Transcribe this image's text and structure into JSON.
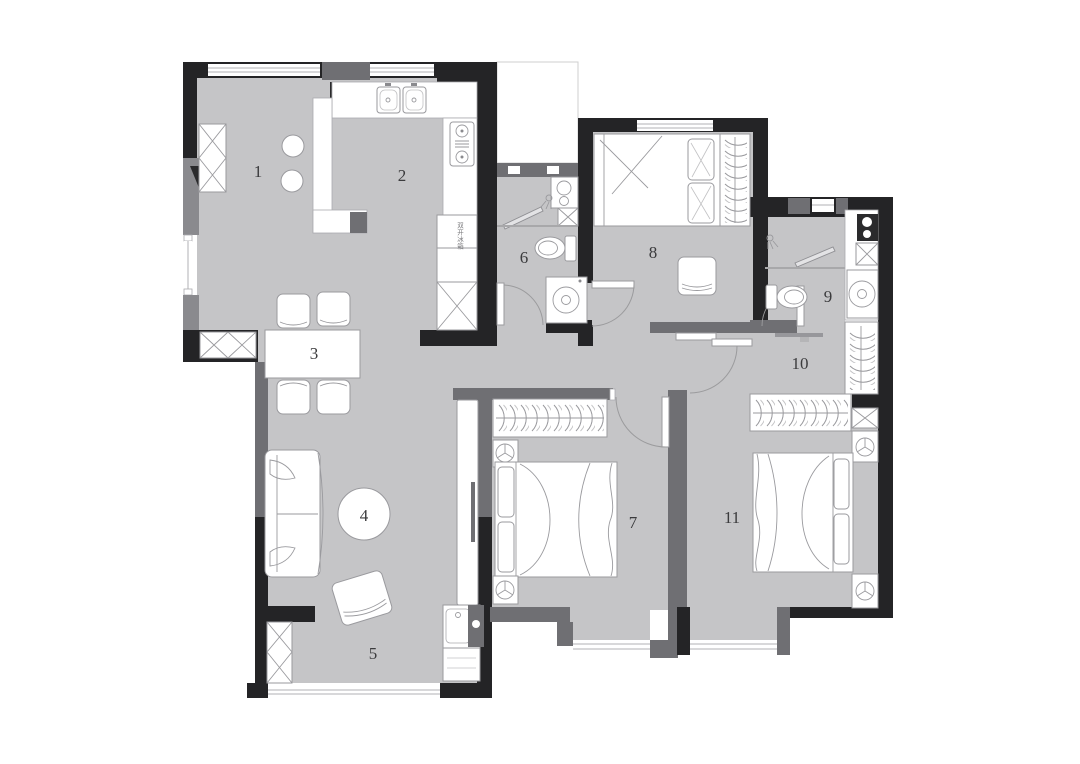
{
  "colors": {
    "floor": "#c5c5c7",
    "wall": "#242426",
    "wall_secondary": "#6f6f73",
    "wall_light": "#8a8a8e",
    "furniture_stroke": "#9a9a9e",
    "label": "#3b3b3d"
  },
  "floorplan": {
    "rooms": [
      {
        "number": "1"
      },
      {
        "number": "2"
      },
      {
        "number": "3"
      },
      {
        "number": "4"
      },
      {
        "number": "5"
      },
      {
        "number": "6"
      },
      {
        "number": "7"
      },
      {
        "number": "8"
      },
      {
        "number": "9"
      },
      {
        "number": "10"
      },
      {
        "number": "11"
      }
    ],
    "fridge_label": "双开冰箱"
  }
}
